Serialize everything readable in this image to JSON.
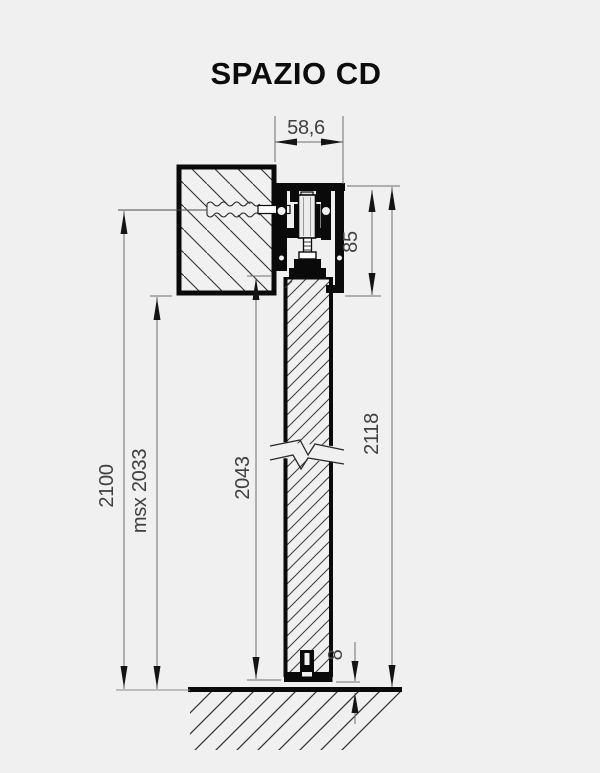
{
  "title": "SPAZIO CD",
  "dimensions": {
    "track_width": "58,6",
    "track_height": "85",
    "overall_height": "2118",
    "door_height": "2043",
    "msx_height": "msx 2033",
    "opening_height": "2100",
    "floor_gap": "8"
  },
  "colors": {
    "background": "#f0f0f0",
    "drawing_line": "#0a0a0a",
    "dimension_line": "#6e6e6e",
    "dimension_text": "#3f3f3f"
  }
}
